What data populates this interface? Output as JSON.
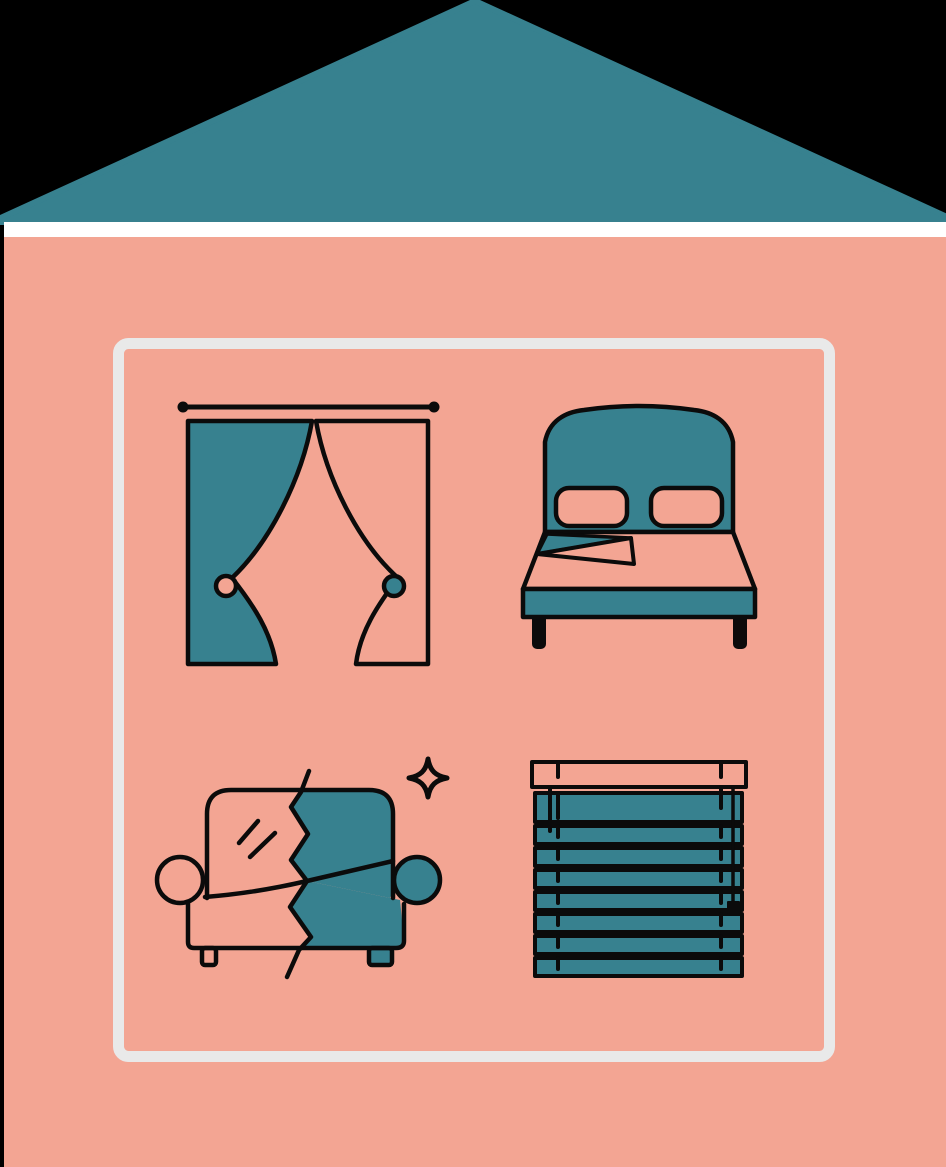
{
  "illustration": {
    "title": "home-textiles-house-illustration",
    "palette": {
      "background": "#000000",
      "teal": "#37818F",
      "salmon": "#F3A593",
      "white": "#FFFFFF",
      "frame_gray": "#E9E9E9",
      "outline": "#0B0B0B"
    },
    "house": {
      "roof_color": "#37818F",
      "eave_strip_color": "#FFFFFF",
      "wall_color": "#F3A593",
      "frame_color": "#E9E9E9"
    },
    "icons": [
      {
        "name": "curtains-icon",
        "item": "curtains",
        "details": "rod with end finials, left panel teal, right panel salmon, tieback circles"
      },
      {
        "name": "bed-icon",
        "item": "bed",
        "details": "teal headboard, two salmon pillows, folded sheet corner, teal base, two legs"
      },
      {
        "name": "sofa-icon",
        "item": "sofa",
        "details": "split by zigzag tear: left half salmon with shine marks, right half teal; sparkle above"
      },
      {
        "name": "blinds-icon",
        "item": "venetian blinds",
        "slat_count": 9,
        "details": "salmon head rail, teal slats, lift cords, right pull cord with knob"
      }
    ],
    "decorations": [
      {
        "name": "sparkle-icon",
        "item": "sparkle"
      }
    ]
  }
}
